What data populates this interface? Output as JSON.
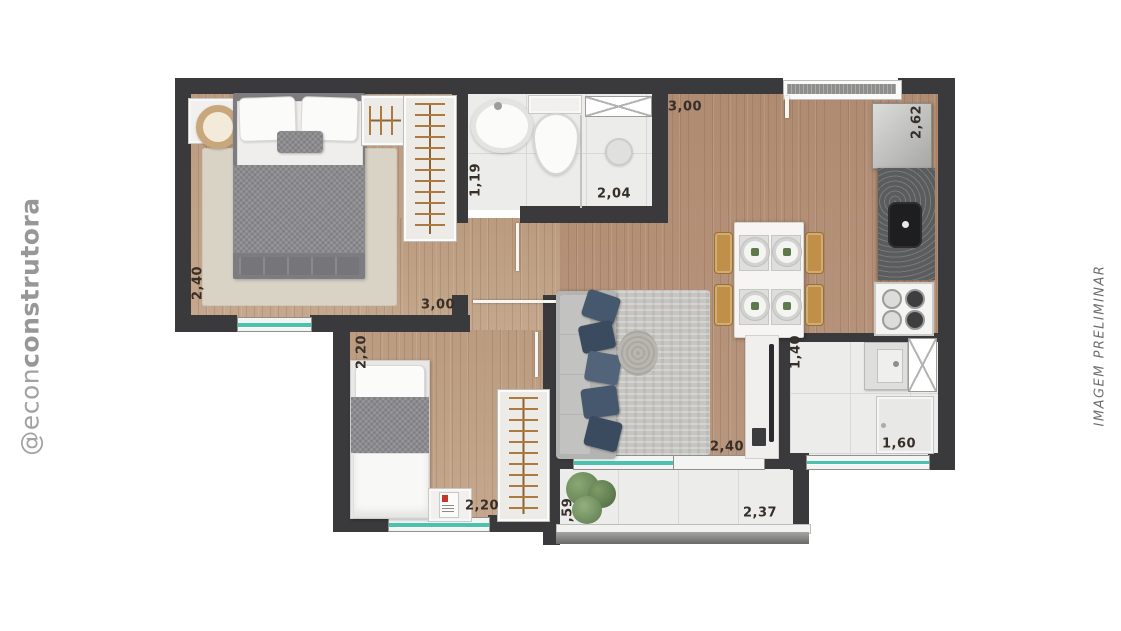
{
  "watermark": {
    "brand_light": "@econ",
    "brand_bold": "construtora",
    "disclaimer": "IMAGEM PRELIMINAR"
  },
  "dims": [
    {
      "id": "bedroom1-width",
      "value": "2,40"
    },
    {
      "id": "bedroom1-length",
      "value": "3,00"
    },
    {
      "id": "bathroom-width",
      "value": "1,19"
    },
    {
      "id": "bathroom-length",
      "value": "2,04"
    },
    {
      "id": "living-top",
      "value": "3,00"
    },
    {
      "id": "kitchen-depth",
      "value": "2,62"
    },
    {
      "id": "kitchen-pass",
      "value": "1,40"
    },
    {
      "id": "living-bottom",
      "value": "2,40"
    },
    {
      "id": "bedroom2-width",
      "value": "2,20"
    },
    {
      "id": "bedroom2-length",
      "value": "2,20"
    },
    {
      "id": "balcony-depth",
      "value": ",59"
    },
    {
      "id": "balcony-length",
      "value": "2,37"
    },
    {
      "id": "laundry-width",
      "value": "1,60"
    }
  ],
  "furniture": [
    "double-bed",
    "bedside-lamp",
    "nightstand",
    "wardrobe",
    "bathroom-sink",
    "toilet",
    "shower",
    "refrigerator",
    "kitchen-counter",
    "kitchen-sink",
    "stove",
    "dining-table",
    "dining-chair",
    "sofa",
    "tv",
    "single-bed",
    "laundry-sink",
    "washing-machine",
    "plant",
    "balcony-railing"
  ],
  "colors": {
    "wall": "#3a393b",
    "wood": "#bfa186",
    "tile": "#ececea",
    "window_glass": "#49c2b0",
    "chair": "#c09048",
    "sofa_pillow": "#46586e",
    "counter": "#5a5c5e",
    "dim_text": "#362e27"
  }
}
